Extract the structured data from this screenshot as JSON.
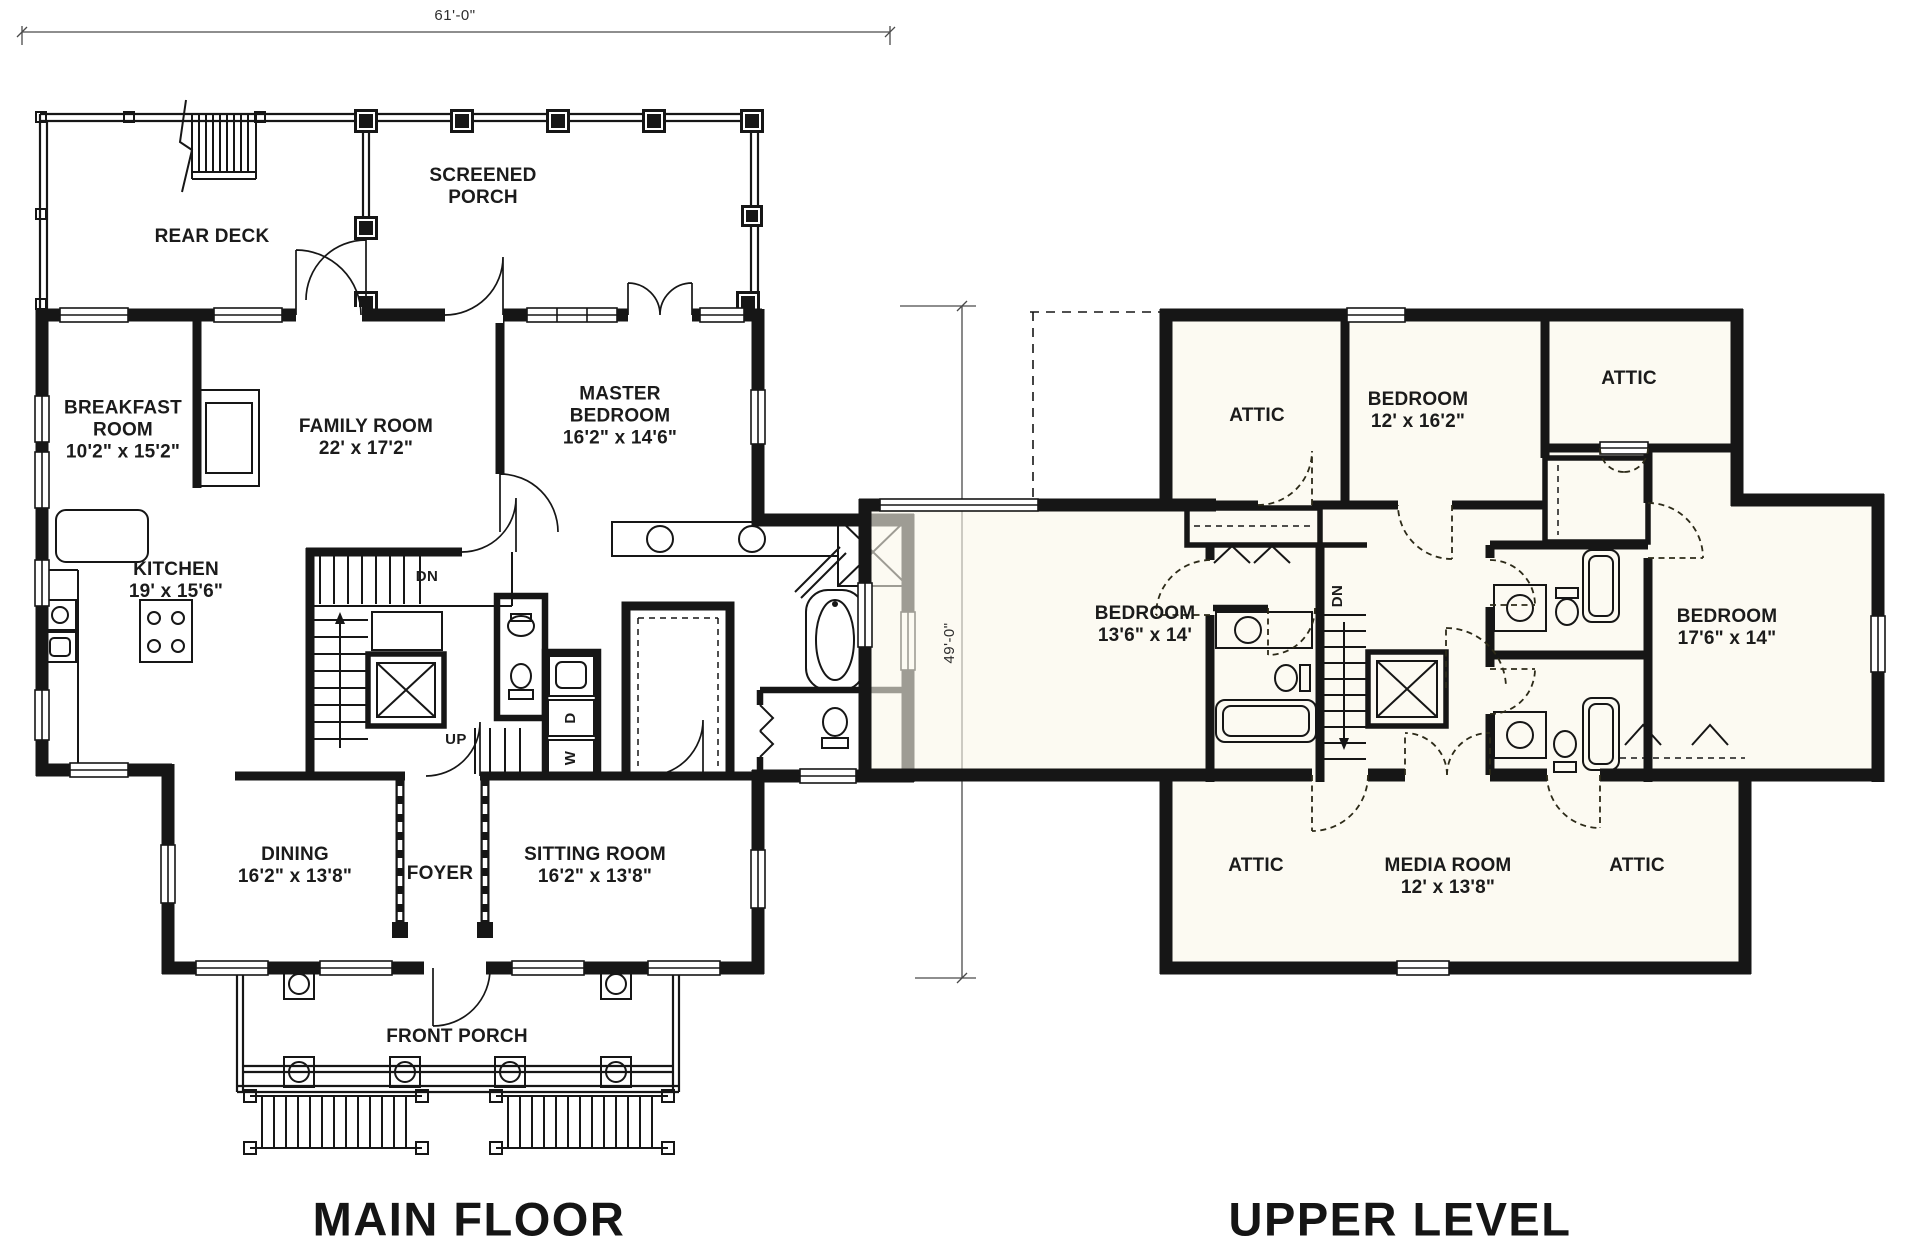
{
  "ink_color": "#161616",
  "plans": {
    "main_floor": {
      "title": "MAIN FLOOR",
      "dimension_width": "61'-0\"",
      "dimension_height": "49'-0\"",
      "rooms": {
        "rear_deck": {
          "name": "REAR DECK"
        },
        "screened_porch": {
          "name": "SCREENED PORCH"
        },
        "breakfast_room": {
          "name": "BREAKFAST ROOM",
          "size": "10'2\" x 15'2\""
        },
        "family_room": {
          "name": "FAMILY ROOM",
          "size": "22' x 17'2\""
        },
        "master_bedroom": {
          "name": "MASTER BEDROOM",
          "size": "16'2\" x 14'6\""
        },
        "kitchen": {
          "name": "KITCHEN",
          "size": "19' x 15'6\""
        },
        "dining": {
          "name": "DINING",
          "size": "16'2\" x 13'8\""
        },
        "foyer": {
          "name": "FOYER"
        },
        "sitting_room": {
          "name": "SITTING ROOM",
          "size": "16'2\" x 13'8\""
        },
        "front_porch": {
          "name": "FRONT PORCH"
        }
      },
      "annotations": {
        "down": "DN",
        "up": "UP",
        "washer": "W",
        "dryer": "D"
      }
    },
    "upper_level": {
      "title": "UPPER LEVEL",
      "rooms": {
        "attic_top_left": {
          "name": "ATTIC"
        },
        "bedroom_top": {
          "name": "BEDROOM",
          "size": "12' x 16'2\""
        },
        "attic_top_right": {
          "name": "ATTIC"
        },
        "bedroom_left": {
          "name": "BEDROOM",
          "size": "13'6\" x 14'"
        },
        "bedroom_right": {
          "name": "BEDROOM",
          "size": "17'6\" x 14\""
        },
        "attic_bottom_left": {
          "name": "ATTIC"
        },
        "media_room": {
          "name": "MEDIA ROOM",
          "size": "12' x 13'8\""
        },
        "attic_bottom_right": {
          "name": "ATTIC"
        }
      },
      "annotations": {
        "down": "DN"
      }
    }
  }
}
